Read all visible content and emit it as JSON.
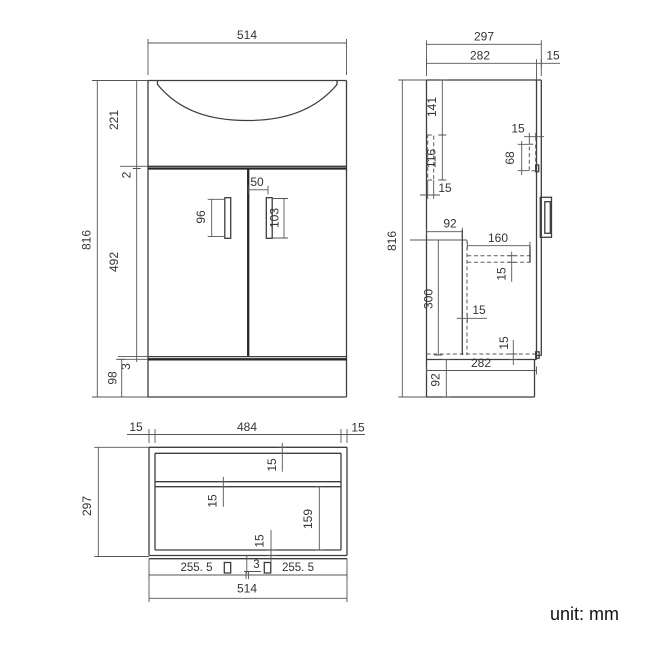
{
  "title": "Vanity unit technical drawing",
  "unit_label": "unit: mm",
  "front_view": {
    "width": "514",
    "height": "816",
    "basin_height": "221",
    "top_gap": "2",
    "door_height": "492",
    "bottom_gap": "3",
    "plinth_height": "98",
    "left_handle": "96",
    "right_handle": "103",
    "handle_offset": "50"
  },
  "side_view": {
    "depth": "297",
    "carcass_depth": "282",
    "door_thickness": "15",
    "height": "816",
    "bracket_top_offset": "141",
    "bracket_length": "116",
    "bracket_width": "15",
    "plate_width": "15",
    "plate_length": "68",
    "recess_depth": "92",
    "shelf_depth": "160",
    "shelf_thickness": "15",
    "opening_height": "300",
    "divider_thickness": "15",
    "bottom_thickness": "15",
    "carcass_depth_bottom": "282",
    "plinth_height": "92"
  },
  "plan_view": {
    "left_panel": "15",
    "inner_width": "484",
    "right_panel": "15",
    "depth": "297",
    "back_panel": "15",
    "rail_thickness": "15",
    "opening_depth": "159",
    "front_panel": "15",
    "left_door": "255. 5",
    "door_gap": "3",
    "right_door": "255. 5",
    "width": "514"
  }
}
